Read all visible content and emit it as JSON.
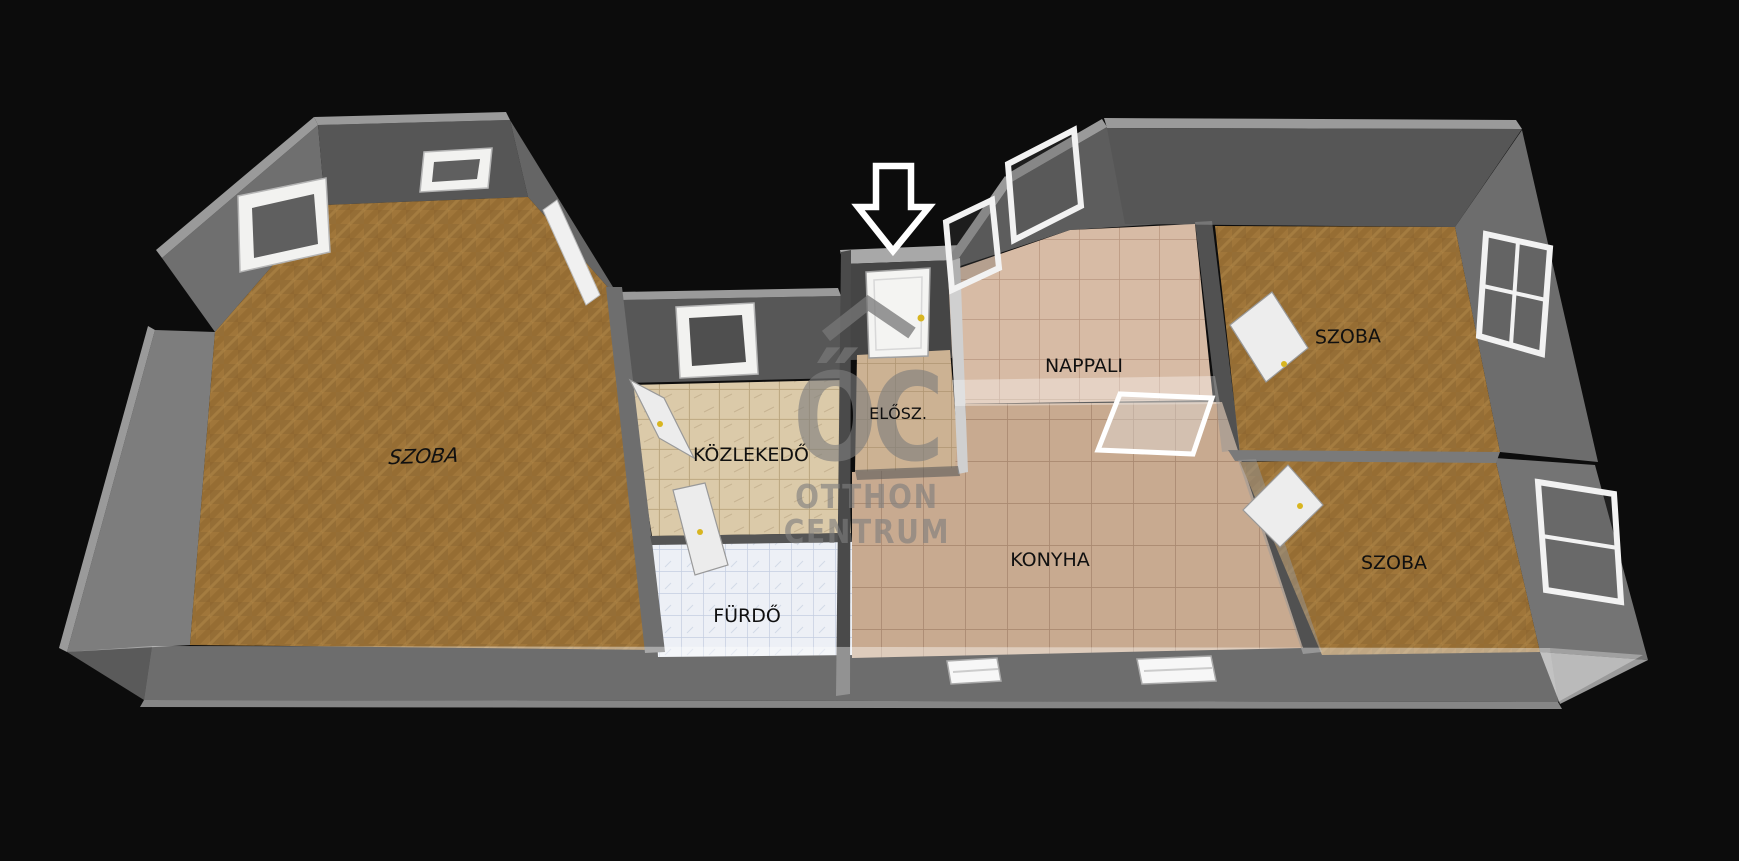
{
  "scene": {
    "type": "3d-floorplan-render",
    "background_color": "#0c0c0c",
    "entrance_arrow_color": "#ffffff"
  },
  "rooms": [
    {
      "id": "szoba-left",
      "label": "SZOBA",
      "floor_material": "parquet",
      "floor_color": "#a0763a"
    },
    {
      "id": "kozlekedo",
      "label": "KÖZLEKEDŐ",
      "floor_material": "beige-tile",
      "floor_color": "#d8c6a3"
    },
    {
      "id": "furdo",
      "label": "FÜRDŐ",
      "floor_material": "bath-tile",
      "floor_color": "#edf0f6"
    },
    {
      "id": "elosz",
      "label": "ELŐSZ.",
      "floor_material": "tan-tile",
      "floor_color": "#ccb293"
    },
    {
      "id": "nappali",
      "label": "NAPPALI",
      "floor_material": "ceramic-tile",
      "floor_color": "#d7bba5"
    },
    {
      "id": "konyha",
      "label": "KONYHA",
      "floor_material": "ceramic-tile",
      "floor_color": "#c8aa90"
    },
    {
      "id": "szoba-top-right",
      "label": "SZOBA",
      "floor_material": "parquet",
      "floor_color": "#a0763a"
    },
    {
      "id": "szoba-bottom-right",
      "label": "SZOBA",
      "floor_material": "parquet",
      "floor_color": "#a0763a"
    }
  ],
  "watermark": {
    "monogram": "ŐC",
    "line1": "OTTHON",
    "line2": "CENTRUM",
    "color": "#7e7e7e"
  },
  "palette": {
    "wall_inner_dark": "#565656",
    "wall_mid": "#6f6f6f",
    "wall_outer_light": "#9a9a9a",
    "door_window_white": "#f2f2f0",
    "door_handle_yellow": "#d8b520",
    "front_glass_wall": "rgba(255,255,255,0.40)"
  }
}
